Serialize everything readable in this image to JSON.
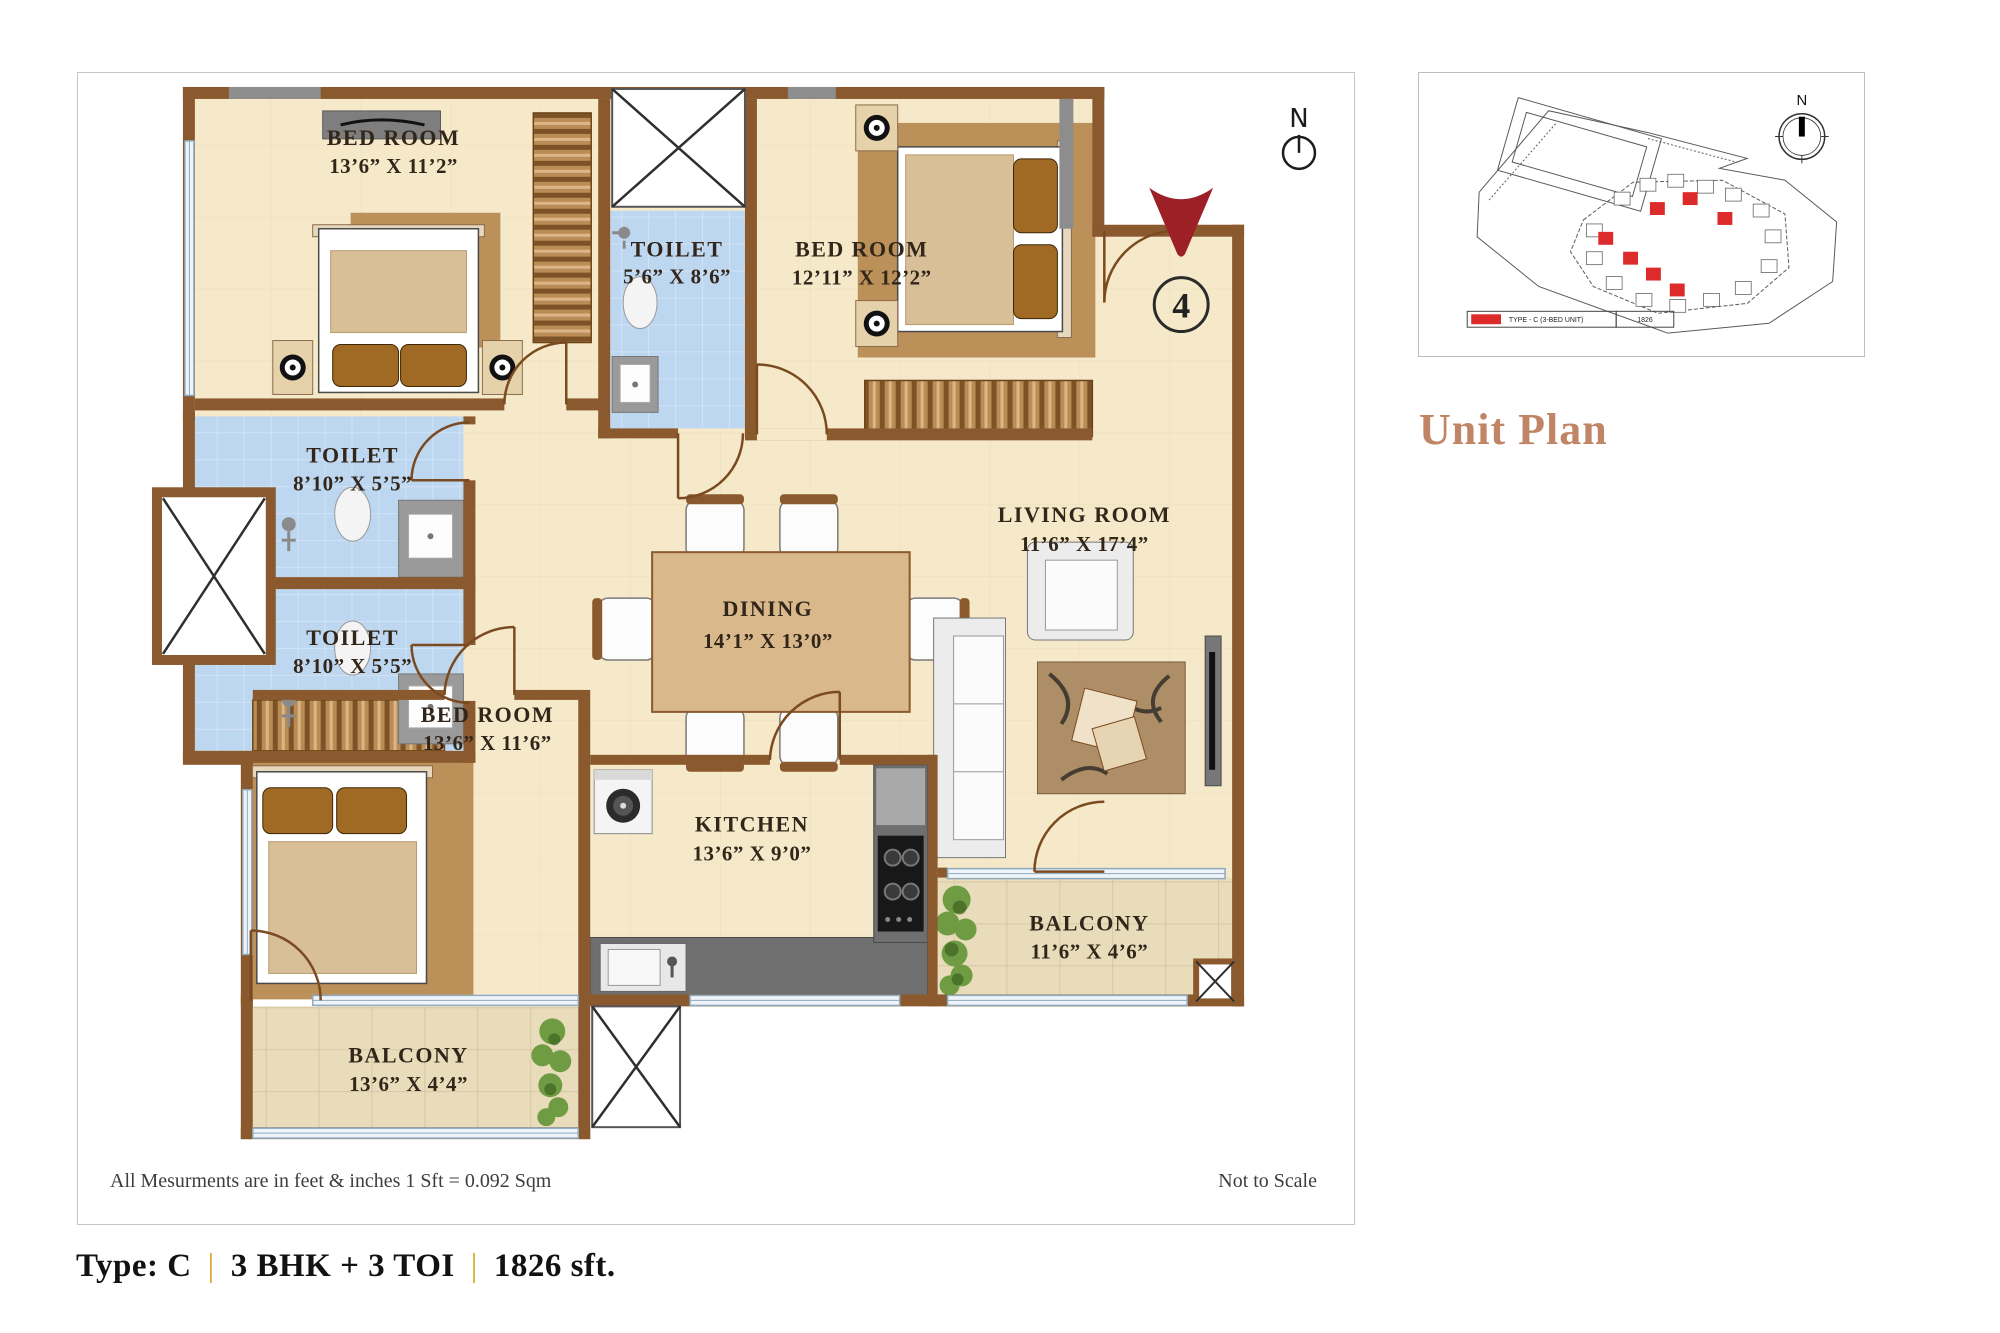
{
  "plan": {
    "footnote": "All Mesurments are in feet & inches 1 Sft = 0.092 Sqm",
    "scale_note": "Not to Scale",
    "north_label": "N",
    "entry_number": "4",
    "rooms": [
      {
        "name": "BED ROOM",
        "dims": "13’6” X 11’2”"
      },
      {
        "name": "TOILET",
        "dims": "5’6” X 8’6”"
      },
      {
        "name": "BED ROOM",
        "dims": "12’11” X 12’2”"
      },
      {
        "name": "TOILET",
        "dims": "8’10” X 5’5”"
      },
      {
        "name": "TOILET",
        "dims": "8’10” X 5’5”"
      },
      {
        "name": "BED ROOM",
        "dims": "13’6” X 11’6”"
      },
      {
        "name": "DINING",
        "dims": "14’1” X 13’0”"
      },
      {
        "name": "LIVING ROOM",
        "dims": "11’6” X 17’4”"
      },
      {
        "name": "KITCHEN",
        "dims": "13’6” X 9’0”"
      },
      {
        "name": "BALCONY",
        "dims": "11’6” X 4’6”"
      },
      {
        "name": "BALCONY",
        "dims": "13’6” X 4’4”"
      }
    ]
  },
  "unit_info": {
    "type_label": "Type: C",
    "separator": "|",
    "config": "3 BHK + 3 TOI",
    "area": "1826 sft."
  },
  "sitemap": {
    "heading": "Unit Plan",
    "north_label": "N",
    "legend": {
      "label": "TYPE - C (3-BED UNIT)",
      "value": "1826"
    }
  },
  "colors": {
    "wall_brown": "#8a5a2e",
    "floor_cream": "#f6e9ca",
    "toilet_blue": "#bed7f0",
    "balcony_tile": "#e9dcba",
    "entry_red": "#9c2026",
    "heading_terracotta": "#c08565",
    "separator_gold": "#dba62b",
    "site_marker_red": "#dd2b2b"
  }
}
